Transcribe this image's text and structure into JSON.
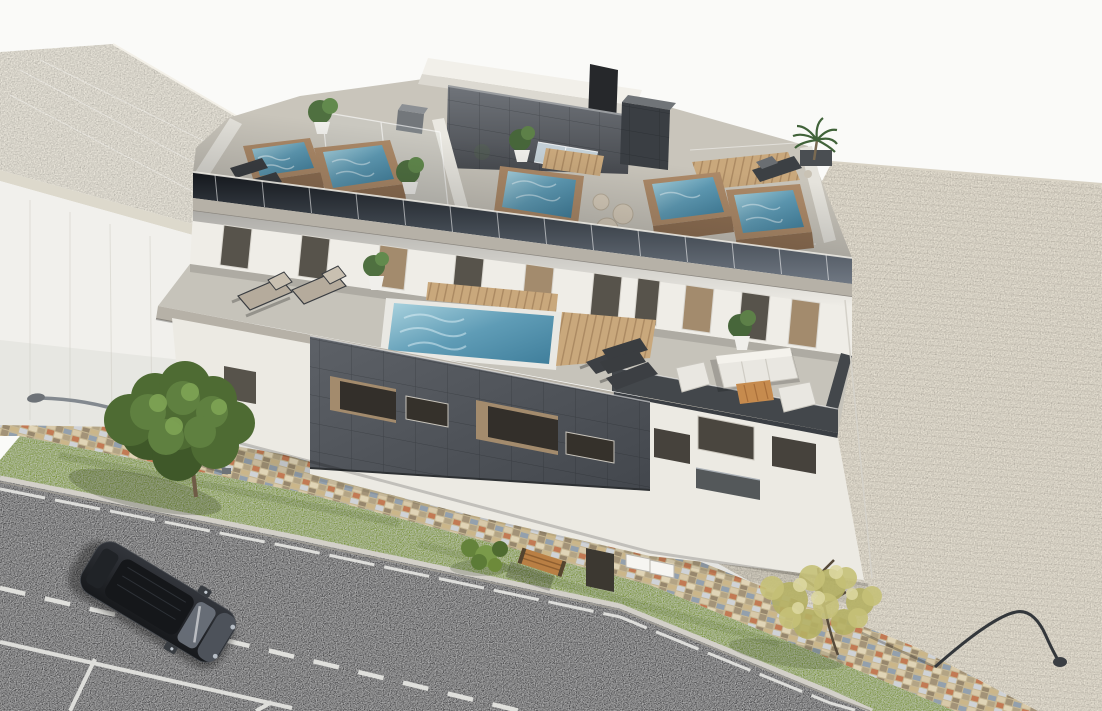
{
  "scene": {
    "kind": "3d-architectural-rendering",
    "subject": "aerial three-quarter view of a modern two-storey apartment block with private rooftop plunge pools, glass balustrades, furnished terraces, a paved corner lot, sidewalk, grass strip and a street with one parked car",
    "time_of_day": "daylight"
  },
  "palette": {
    "sky": "#fafaf8",
    "neighbor_roof": "#e9e5da",
    "neighbor_wall": "#f1f0ec",
    "deck_gray": "#c9c5bb",
    "fascia_light": "#b6b1a7",
    "wall_white": "#efede7",
    "window_dark": "#57534b",
    "window_tan": "#a38b6d",
    "terrace_floor": "#c6c3ba",
    "terrace_dark_deck": "#43474b",
    "pool_water_light": "#a9d2de",
    "pool_water": "#5f9cb6",
    "pool_water_deep": "#3f7e9b",
    "pool_brick": "#ad8a68",
    "pool_brick_dark": "#8f6f52",
    "wood_deck": "#c9a87c",
    "charcoal_wall": "#53575d",
    "charcoal_dark": "#3a3e43",
    "penthouse_top": "#f2f0ea",
    "facade_white": "#eceae3",
    "grass": "#7f973d",
    "asphalt": "#4e4e50",
    "road_line": "#e8e8e4",
    "sidewalk_base": "#c6b794",
    "paved_lot": "#e7e1d3",
    "car_body": "#24262b",
    "tree_green": "#5f8040",
    "tree_yellow": "#c6c178",
    "lamp_gray": "#83898f",
    "lamp_dark": "#33373b",
    "bench_wood": "#b97f44"
  },
  "inventory": {
    "rooftop_pools": 5,
    "glass_covered_spa": 1,
    "terrace_pools": 1,
    "sun_loungers": 8,
    "outdoor_sofa_sets": 1,
    "pouf_seats": 3,
    "potted_plants": 7,
    "palm_trees": 1,
    "street_trees": 2,
    "street_lamps": 2,
    "benches": 1,
    "parked_cars": 1,
    "marked_parking_spaces": 2,
    "road_lane_lines": 2
  }
}
